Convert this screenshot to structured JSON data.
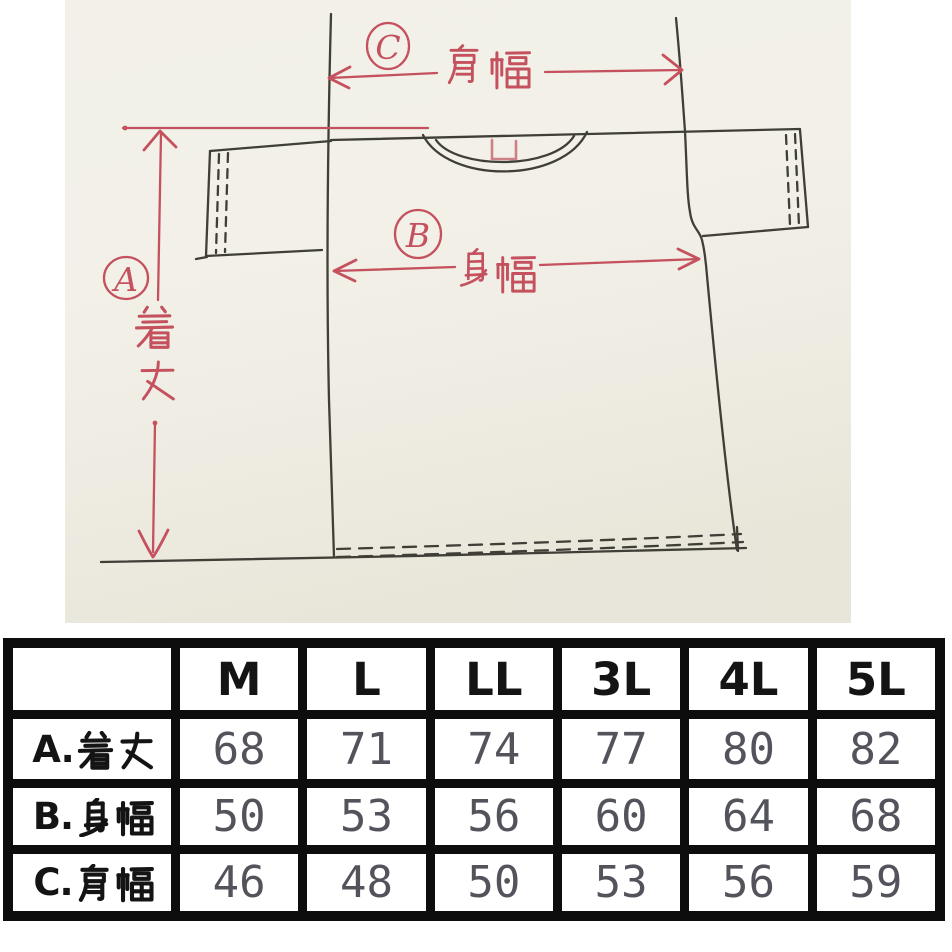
{
  "diagram": {
    "annotations": {
      "a": {
        "letter": "A",
        "label": "着丈"
      },
      "b": {
        "letter": "B",
        "label": "身幅"
      },
      "c": {
        "letter": "C",
        "label": "肩幅"
      }
    }
  },
  "size_table": {
    "corner_label": "",
    "columns": [
      "M",
      "L",
      "LL",
      "3L",
      "4L",
      "5L"
    ],
    "rows": [
      {
        "prefix": "A.",
        "kanji": "着丈",
        "label": "A.着丈",
        "values": [
          "68",
          "71",
          "74",
          "77",
          "80",
          "82"
        ]
      },
      {
        "prefix": "B.",
        "kanji": "身幅",
        "label": "B.身幅",
        "values": [
          "50",
          "53",
          "56",
          "60",
          "64",
          "68"
        ]
      },
      {
        "prefix": "C.",
        "kanji": "肩幅",
        "label": "C.肩幅",
        "values": [
          "46",
          "48",
          "50",
          "53",
          "56",
          "59"
        ]
      }
    ]
  },
  "colors": {
    "photo_background": "#f2f0e7",
    "sketch_ink": "#3f3e37",
    "annotation_red": "#c4515d",
    "tag_pink": "#cf8086",
    "table_border": "#0d0d0d",
    "value_text": "#53535c",
    "header_text": "#141414"
  }
}
